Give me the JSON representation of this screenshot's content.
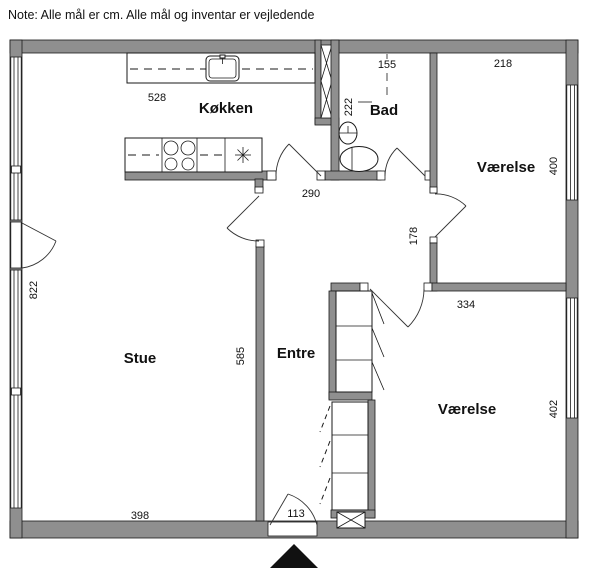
{
  "note": "Note: Alle mål er cm. Alle mål og inventar er vejledende",
  "rooms": {
    "koekken": "Køkken",
    "bad": "Bad",
    "vaerelse_top": "Værelse",
    "vaerelse_bottom": "Værelse",
    "stue": "Stue",
    "entre": "Entre"
  },
  "dimensions": {
    "kitchen_width": "528",
    "bath_width": "155",
    "bedroom_top_width": "218",
    "bath_depth": "222",
    "bedroom_top_depth": "400",
    "hall_width": "290",
    "passage_width": "178",
    "living_depth": "822",
    "bedroom_bottom_width": "334",
    "living_wall": "585",
    "bedroom_bottom_depth": "402",
    "living_width": "398",
    "entry_door_width": "113"
  },
  "colors": {
    "wall": "#8f8f8f",
    "line": "#1a1a1a",
    "background": "#ffffff"
  }
}
